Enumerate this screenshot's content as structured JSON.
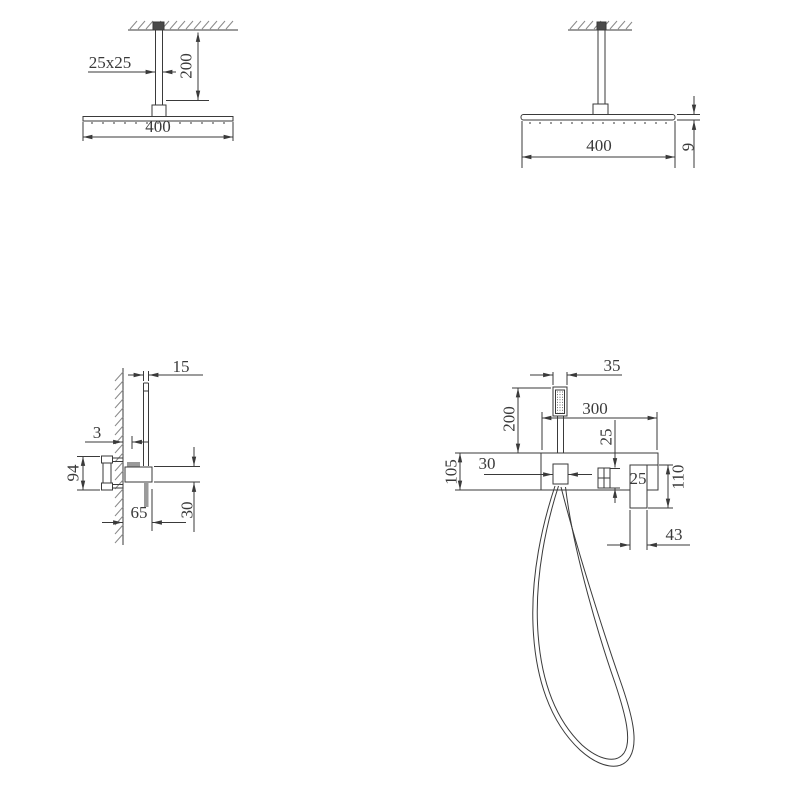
{
  "drawing_title": "shower set technical drawing",
  "meta": {
    "background": "#ffffff",
    "line_color": "#3a3a3a",
    "hatch_color": "#8a8a8a",
    "mount_fill": "#4a4a4a",
    "gray_fill": "#9a9a9a"
  },
  "views": {
    "ceiling_front": {
      "label": "ceiling shower head front view",
      "dims": {
        "arm_section": "25x25",
        "arm_length": "200",
        "head_width": "400"
      }
    },
    "ceiling_side": {
      "label": "ceiling shower head side view",
      "dims": {
        "head_width": "400",
        "head_thickness": "9"
      }
    },
    "hand_side": {
      "label": "hand shower and mixer side view",
      "dims": {
        "handset_width": "15",
        "wall_gap": "3",
        "valve_height": "94",
        "projection": "65",
        "bracket_height": "30"
      }
    },
    "hand_front": {
      "label": "hand shower and mixer front view",
      "dims": {
        "handset_width": "35",
        "handset_drop": "200",
        "bar_width": "300",
        "knob_drop": "25",
        "holder_width": "30",
        "bar_height": "105",
        "spout_label": "25",
        "spout_height": "110",
        "spout_width": "43"
      }
    }
  }
}
